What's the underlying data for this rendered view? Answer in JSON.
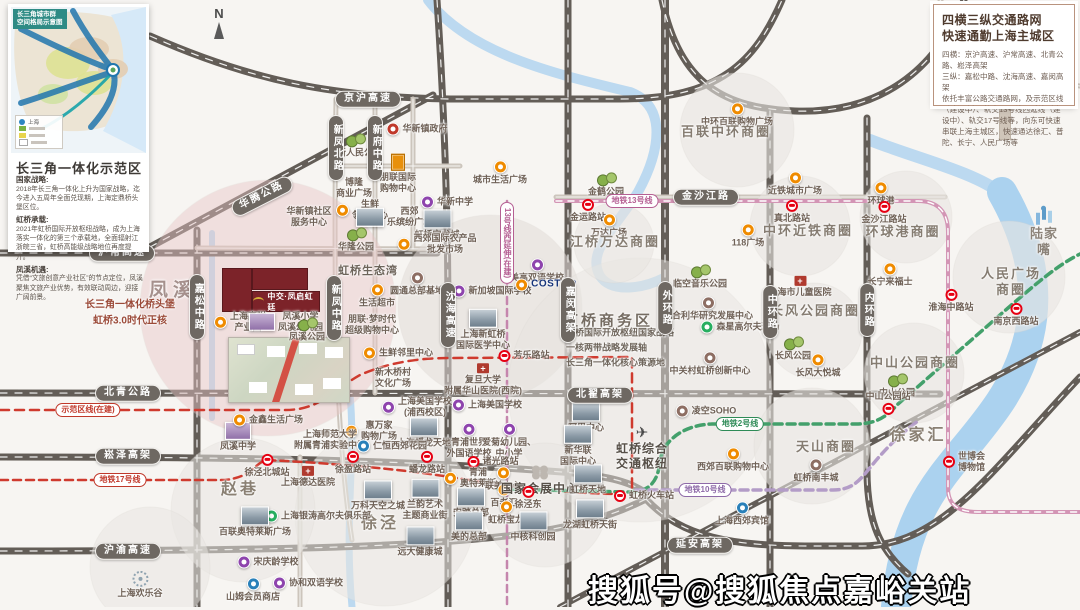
{
  "inset": {
    "header": "长三角城市群\n空间格局示意图",
    "title": "长三角一体化示范区",
    "legend": [
      "上海"
    ],
    "sections": [
      {
        "h": "国家战略:",
        "b": "2018年长三角一体化上升为国家战略，迄今进入五周年全面兑现期，上海定鼎桥头堡区位。"
      },
      {
        "h": "虹桥承载:",
        "b": "2021年虹桥国际开放枢纽战略，成为上海落实一体化的第三个承载地，全面辐射江浙皖三省，虹桥高能级战略地位再度提升。"
      },
      {
        "h": "凤溪机遇:",
        "b": "凭借“文旅创意产业社区”的节点定位，凤溪聚焦文旅产业优势，有效联动周边，迎接广阔前景。"
      }
    ]
  },
  "traffic": {
    "title_line1": "四横三纵交通路网",
    "title_line2": "快速通勤上海主城区",
    "body": [
      "四横：京沪高速、沪常高速、北青公路、崧泽高架",
      "三纵：嘉松中路、沈海高速、嘉闵高架",
      "依托丰富公路交通路网，及示范区线（建设中）、轨交13号线西延线（建设中）、轨交17号线等，向东可快速串联上海主城区，快速通达徐汇、普陀、长宁、人民广场等"
    ]
  },
  "project": {
    "logo": "中交·凤启虹廷"
  },
  "watermark": "搜狐号@搜狐焦点嘉峪关站",
  "compass": "N",
  "colors": {
    "plot_red": "#7c2329",
    "line13": "#d395b5",
    "line2": "#43a06b",
    "line10": "#b39cc7",
    "line17_demo": "#cf3a2e",
    "metro_logo": "#e60012",
    "poi_orange": "#ef8b00",
    "school_purple": "#8e44ad"
  },
  "map": {
    "road_labels": [
      {
        "t": "京沪高速",
        "x": 368,
        "y": 99
      },
      {
        "t": "沪常高速",
        "x": 122,
        "y": 253
      },
      {
        "t": "北青公路",
        "x": 128,
        "y": 393
      },
      {
        "t": "崧泽高架",
        "x": 128,
        "y": 456
      },
      {
        "t": "沪渝高速",
        "x": 128,
        "y": 551
      },
      {
        "t": "金沙江路",
        "x": 706,
        "y": 197
      },
      {
        "t": "北翟高架",
        "x": 600,
        "y": 395
      },
      {
        "t": "延安高架",
        "x": 700,
        "y": 545
      },
      {
        "t": "华腾公路",
        "x": 262,
        "y": 196,
        "r": -27
      },
      {
        "t": "嘉松中路",
        "x": 197,
        "y": 307,
        "v": 1
      },
      {
        "t": "新凤北路",
        "x": 336,
        "y": 148,
        "v": 1
      },
      {
        "t": "新府中路",
        "x": 375,
        "y": 148,
        "v": 1
      },
      {
        "t": "新凤中路",
        "x": 334,
        "y": 308,
        "v": 1
      },
      {
        "t": "沈海高速",
        "x": 448,
        "y": 315,
        "v": 1
      },
      {
        "t": "嘉闵高架",
        "x": 568,
        "y": 310,
        "v": 1
      },
      {
        "t": "外环路",
        "x": 665,
        "y": 308,
        "v": 1
      },
      {
        "t": "中环路",
        "x": 770,
        "y": 312,
        "v": 1
      },
      {
        "t": "内环路",
        "x": 867,
        "y": 310,
        "v": 1
      }
    ],
    "line_badges": [
      {
        "t": "地铁13号线",
        "x": 632,
        "y": 201,
        "c": "badge bk-pink"
      },
      {
        "t": "13号线西延伸(在建)",
        "x": 507,
        "y": 243,
        "c": "badge bk-pink",
        "v": 1
      },
      {
        "t": "示范区线(在建)",
        "x": 88,
        "y": 410,
        "c": "badge bk-red"
      },
      {
        "t": "地铁17号线",
        "x": 120,
        "y": 480,
        "c": "badge bk-red"
      },
      {
        "t": "地铁2号线",
        "x": 740,
        "y": 424,
        "c": "badge bk-green"
      },
      {
        "t": "地铁10号线",
        "x": 705,
        "y": 490,
        "c": "badge bk-purple"
      }
    ],
    "labels": [
      {
        "t": "华新人民公园",
        "x": 355,
        "y": 146,
        "i": "tree"
      },
      {
        "t": "华新镇政府",
        "x": 417,
        "y": 129,
        "i": "gov",
        "ip": "left"
      },
      {
        "t": "朋联国际\n购物中心",
        "x": 398,
        "y": 174,
        "i": "tower"
      },
      {
        "t": "博隆\n商业广场",
        "x": 354,
        "y": 188
      },
      {
        "t": "华新镇社区\n服务中心",
        "x": 309,
        "y": 217
      },
      {
        "t": "生鲜\n邻里中心",
        "x": 362,
        "y": 210,
        "i": "dot",
        "ip": "left"
      },
      {
        "t": "西郊\n乐缤纷广场",
        "x": 394,
        "y": 217,
        "i": "thumb",
        "ip": "left"
      },
      {
        "t": "华新中学",
        "x": 447,
        "y": 202,
        "i": "school",
        "ip": "left"
      },
      {
        "t": "虹桥宝龙城",
        "x": 437,
        "y": 225,
        "i": "thumb"
      },
      {
        "t": "西郊国际农产品\n批发市场",
        "x": 437,
        "y": 244,
        "i": "dot",
        "ip": "left"
      },
      {
        "t": "华隆公园",
        "x": 356,
        "y": 240,
        "i": "tree"
      },
      {
        "t": "虹桥生态湾",
        "x": 368,
        "y": 272,
        "c": "poiB"
      },
      {
        "t": "生活超市",
        "x": 377,
        "y": 296,
        "i": "dot"
      },
      {
        "t": "朋联·梦时代\n超级购物中心",
        "x": 372,
        "y": 325
      },
      {
        "t": "生鲜邻里中心",
        "x": 398,
        "y": 353,
        "i": "dot",
        "ip": "left"
      },
      {
        "t": "新木桥村\n文化广场",
        "x": 393,
        "y": 378
      },
      {
        "t": "圆通总部基地",
        "x": 417,
        "y": 284,
        "i": "brown"
      },
      {
        "t": "新加坡国际学校",
        "x": 492,
        "y": 291,
        "i": "school",
        "ip": "left"
      },
      {
        "t": "美高双语学校",
        "x": 537,
        "y": 271,
        "i": "school"
      },
      {
        "t": "COSTCO",
        "x": 546,
        "y": 285,
        "c": "poi costco",
        "i": "dot",
        "ip": "left"
      },
      {
        "t": "上海新虹桥\n国际医学中心",
        "x": 483,
        "y": 330,
        "i": "thumb"
      },
      {
        "t": "芳乐路站",
        "x": 524,
        "y": 356,
        "i": "metro",
        "ip": "left"
      },
      {
        "t": "复旦大学\n附属华山医院(西院)",
        "x": 483,
        "y": 380,
        "i": "hosp"
      },
      {
        "t": "上海美国学校\n(浦西校区)",
        "x": 417,
        "y": 407,
        "i": "school",
        "ip": "left"
      },
      {
        "t": "上海美国学校",
        "x": 487,
        "y": 405,
        "i": "school",
        "ip": "left"
      },
      {
        "t": "上海蟠龙天地",
        "x": 424,
        "y": 433,
        "i": "thumb"
      },
      {
        "t": "惠万家\n购物广场",
        "x": 371,
        "y": 431,
        "i": "dot",
        "ip": "left"
      },
      {
        "t": "上海师范大学\n附属青浦实验中学",
        "x": 330,
        "y": 440
      },
      {
        "t": "仁恒西郊花园",
        "x": 392,
        "y": 446,
        "i": "blue",
        "ip": "left"
      },
      {
        "t": "徐盈路站",
        "x": 353,
        "y": 463,
        "i": "metro"
      },
      {
        "t": "蟠龙路站",
        "x": 427,
        "y": 463,
        "i": "metro"
      },
      {
        "t": "万科天空之城",
        "x": 378,
        "y": 496,
        "i": "thumb"
      },
      {
        "t": "兰韵艺术\n主题商业街",
        "x": 425,
        "y": 500,
        "i": "thumb"
      },
      {
        "t": "徐泾",
        "x": 380,
        "y": 524,
        "c": "town"
      },
      {
        "t": "远大健康城",
        "x": 420,
        "y": 542,
        "i": "thumb"
      },
      {
        "t": "上海银涛高尔夫俱乐部",
        "x": 318,
        "y": 516,
        "i": "green",
        "ip": "left"
      },
      {
        "t": "上海德达医院",
        "x": 308,
        "y": 477,
        "i": "hosp"
      },
      {
        "t": "赵巷",
        "x": 240,
        "y": 490,
        "c": "town"
      },
      {
        "t": "百联奥特莱斯广场",
        "x": 255,
        "y": 522,
        "i": "thumb"
      },
      {
        "t": "徐泾北城站",
        "x": 267,
        "y": 466,
        "i": "metro"
      },
      {
        "t": "凤溪中学",
        "x": 238,
        "y": 437,
        "i": "thumbp"
      },
      {
        "t": "金鑫生活广场",
        "x": 268,
        "y": 420,
        "i": "dot",
        "ip": "left"
      },
      {
        "t": "上海欢乐谷",
        "x": 140,
        "y": 585,
        "i": "ferris"
      },
      {
        "t": "宋庆龄学校",
        "x": 268,
        "y": 562,
        "i": "school",
        "ip": "left"
      },
      {
        "t": "山姆会员商店",
        "x": 253,
        "y": 590,
        "i": "blue"
      },
      {
        "t": "协和双语学校",
        "x": 308,
        "y": 583,
        "i": "school",
        "ip": "left"
      },
      {
        "t": "青浦世界\n外国语学校",
        "x": 469,
        "y": 441,
        "i": "school"
      },
      {
        "t": "爱菊幼儿园、\n中小学",
        "x": 509,
        "y": 441,
        "i": "school"
      },
      {
        "t": "诸光路站",
        "x": 493,
        "y": 462,
        "i": "metro",
        "ip": "left"
      },
      {
        "t": "青浦\n奥特莱斯",
        "x": 470,
        "y": 478,
        "i": "dot",
        "ip": "left"
      },
      {
        "t": "联美中心",
        "x": 503,
        "y": 479,
        "i": "dot"
      },
      {
        "t": "百老汇",
        "x": 504,
        "y": 496,
        "i": "dot"
      },
      {
        "t": "安踏总部",
        "x": 471,
        "y": 503,
        "i": "thumb"
      },
      {
        "t": "虹桥宝龙",
        "x": 506,
        "y": 513,
        "i": "dot"
      },
      {
        "t": "美的总部",
        "x": 469,
        "y": 527,
        "i": "thumb"
      },
      {
        "t": "国家会展中心",
        "x": 540,
        "y": 481,
        "c": "poiBB",
        "i": "clover"
      },
      {
        "t": "徐泾东",
        "x": 528,
        "y": 498,
        "i": "metro"
      },
      {
        "t": "中核科创园",
        "x": 533,
        "y": 527,
        "i": "thumb"
      },
      {
        "t": "阿里中心",
        "x": 586,
        "y": 418,
        "i": "thumb"
      },
      {
        "t": "新华联\n国际中心",
        "x": 578,
        "y": 446,
        "i": "thumb"
      },
      {
        "t": "虹桥综合\n交通枢纽",
        "x": 642,
        "y": 448,
        "c": "poiBB",
        "i": "plane"
      },
      {
        "t": "虹桥天地",
        "x": 588,
        "y": 480,
        "i": "thumb"
      },
      {
        "t": "虹桥火车站",
        "x": 644,
        "y": 496,
        "i": "metro",
        "ip": "left"
      },
      {
        "t": "龙湖虹桥天街",
        "x": 590,
        "y": 515,
        "i": "thumb"
      },
      {
        "t": "凌空SOHO",
        "x": 706,
        "y": 411,
        "i": "brown",
        "ip": "left"
      },
      {
        "t": "西郊百联购物中心",
        "x": 733,
        "y": 460,
        "i": "dot"
      },
      {
        "t": "上海西郊宾馆",
        "x": 742,
        "y": 514,
        "i": "blue"
      },
      {
        "t": "天山商圈",
        "x": 826,
        "y": 447,
        "c": "area"
      },
      {
        "t": "虹桥南丰城",
        "x": 816,
        "y": 471,
        "i": "brown"
      },
      {
        "t": "临空音乐公园",
        "x": 700,
        "y": 277,
        "i": "tree"
      },
      {
        "t": "联合利华研究发展中心",
        "x": 708,
        "y": 309,
        "i": "brown"
      },
      {
        "t": "森星高尔夫球场",
        "x": 740,
        "y": 327,
        "i": "green",
        "ip": "left"
      },
      {
        "t": "中关村虹桥创新中心",
        "x": 710,
        "y": 364,
        "i": "brown"
      },
      {
        "t": "虹桥商务区",
        "x": 608,
        "y": 322,
        "c": "bizT"
      },
      {
        "t": "虹桥国际开放枢纽国家战略\n一核两带战略发展轴\n长三角一体化核心策源地",
        "x": 620,
        "y": 348,
        "c": "bizD"
      },
      {
        "t": "中环百联购物广场",
        "x": 737,
        "y": 115,
        "i": "dot"
      },
      {
        "t": "百联中环商圈",
        "x": 726,
        "y": 132,
        "c": "area"
      },
      {
        "t": "金鹤公园",
        "x": 606,
        "y": 185,
        "i": "tree"
      },
      {
        "t": "金运路站",
        "x": 588,
        "y": 211,
        "i": "metro"
      },
      {
        "t": "万达广场",
        "x": 609,
        "y": 226,
        "i": "dot"
      },
      {
        "t": "江桥万达商圈",
        "x": 615,
        "y": 242,
        "c": "area"
      },
      {
        "t": "近铁城市广场",
        "x": 795,
        "y": 184,
        "i": "dot"
      },
      {
        "t": "真北路站",
        "x": 792,
        "y": 212,
        "i": "metro"
      },
      {
        "t": "中环近铁商圈",
        "x": 808,
        "y": 231,
        "c": "area"
      },
      {
        "t": "118广场",
        "x": 748,
        "y": 236,
        "i": "dot"
      },
      {
        "t": "环球港",
        "x": 881,
        "y": 194,
        "i": "dot"
      },
      {
        "t": "金沙江路站",
        "x": 884,
        "y": 213,
        "i": "metro"
      },
      {
        "t": "环球港商圈",
        "x": 903,
        "y": 232,
        "c": "area"
      },
      {
        "t": "陆家嘴",
        "x": 1044,
        "y": 232,
        "c": "area2",
        "i": "skyline"
      },
      {
        "t": "人民广场商圈",
        "x": 1011,
        "y": 282,
        "c": "area"
      },
      {
        "t": "淮海中路站",
        "x": 951,
        "y": 301,
        "i": "metro"
      },
      {
        "t": "南京西路站",
        "x": 1016,
        "y": 315,
        "i": "metro"
      },
      {
        "t": "长宁来福士",
        "x": 890,
        "y": 275,
        "i": "dot"
      },
      {
        "t": "上海市儿童医院",
        "x": 800,
        "y": 287,
        "i": "hosp"
      },
      {
        "t": "长风公园商圈",
        "x": 815,
        "y": 311,
        "c": "area"
      },
      {
        "t": "长风公园",
        "x": 793,
        "y": 349,
        "i": "tree"
      },
      {
        "t": "长风大悦城",
        "x": 818,
        "y": 366,
        "i": "dot"
      },
      {
        "t": "中山公园商圈",
        "x": 915,
        "y": 363,
        "c": "area"
      },
      {
        "t": "中山公园",
        "x": 897,
        "y": 386,
        "i": "tree"
      },
      {
        "t": "中山公园站",
        "x": 888,
        "y": 403,
        "i": "metro",
        "ip": "bottom"
      },
      {
        "t": "徐家汇",
        "x": 918,
        "y": 436,
        "c": "town"
      },
      {
        "t": "世博会\n博物馆",
        "x": 964,
        "y": 462,
        "i": "metro",
        "ip": "left"
      },
      {
        "t": "凤溪",
        "x": 173,
        "y": 291,
        "c": "townP"
      },
      {
        "t": "长三角一体化桥头堡\n虹桥3.0时代正核",
        "x": 130,
        "y": 313,
        "c": "slogan"
      },
      {
        "t": "上海高附\n产业园",
        "x": 240,
        "y": 322,
        "i": "dot",
        "ip": "left"
      },
      {
        "t": "凤溪小学\n凤溪幼儿园",
        "x": 286,
        "y": 322,
        "i": "thumbp",
        "ip": "left"
      },
      {
        "t": "凤溪公园",
        "x": 307,
        "y": 330,
        "i": "tree"
      },
      {
        "t": "城市生活广场",
        "x": 500,
        "y": 173,
        "i": "dot"
      }
    ]
  }
}
